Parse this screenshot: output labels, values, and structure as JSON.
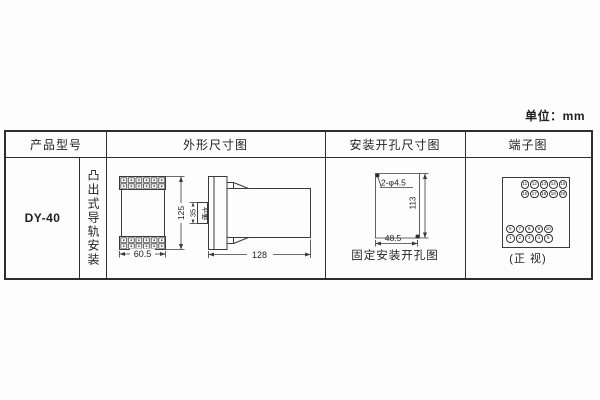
{
  "unit_label": "单位：mm",
  "table": {
    "headers": {
      "col1": "产品型号",
      "col2": "外形尺寸图",
      "col3": "安装开孔尺寸图",
      "col4": "端子图"
    },
    "model": "DY-40",
    "mount_type": "凸出式导轨安装"
  },
  "outline_drawing": {
    "width_dim": "60.5",
    "height_dim": "125",
    "rail_dim": "35",
    "rail_label": "卡槽",
    "depth_dim": "128"
  },
  "hole_drawing": {
    "holes_label": "2-φ4.5",
    "height_dim": "113",
    "width_dim": "48.5",
    "caption": "固定安装开孔图"
  },
  "terminal_diagram": {
    "caption": "(正 视)",
    "top_rows": [
      [
        "11",
        "12",
        "13",
        "14",
        "15"
      ],
      [
        "16",
        "17",
        "18",
        "19",
        "20"
      ]
    ],
    "bottom_rows": [
      [
        "6",
        "7",
        "8",
        "9",
        "10"
      ],
      [
        "1",
        "2",
        "3",
        "4",
        "5"
      ]
    ]
  },
  "colors": {
    "line": "#2e2e2e",
    "drawing_line": "#3a3a3a",
    "text": "#1f1f1f",
    "background": "#fdfdfd"
  }
}
